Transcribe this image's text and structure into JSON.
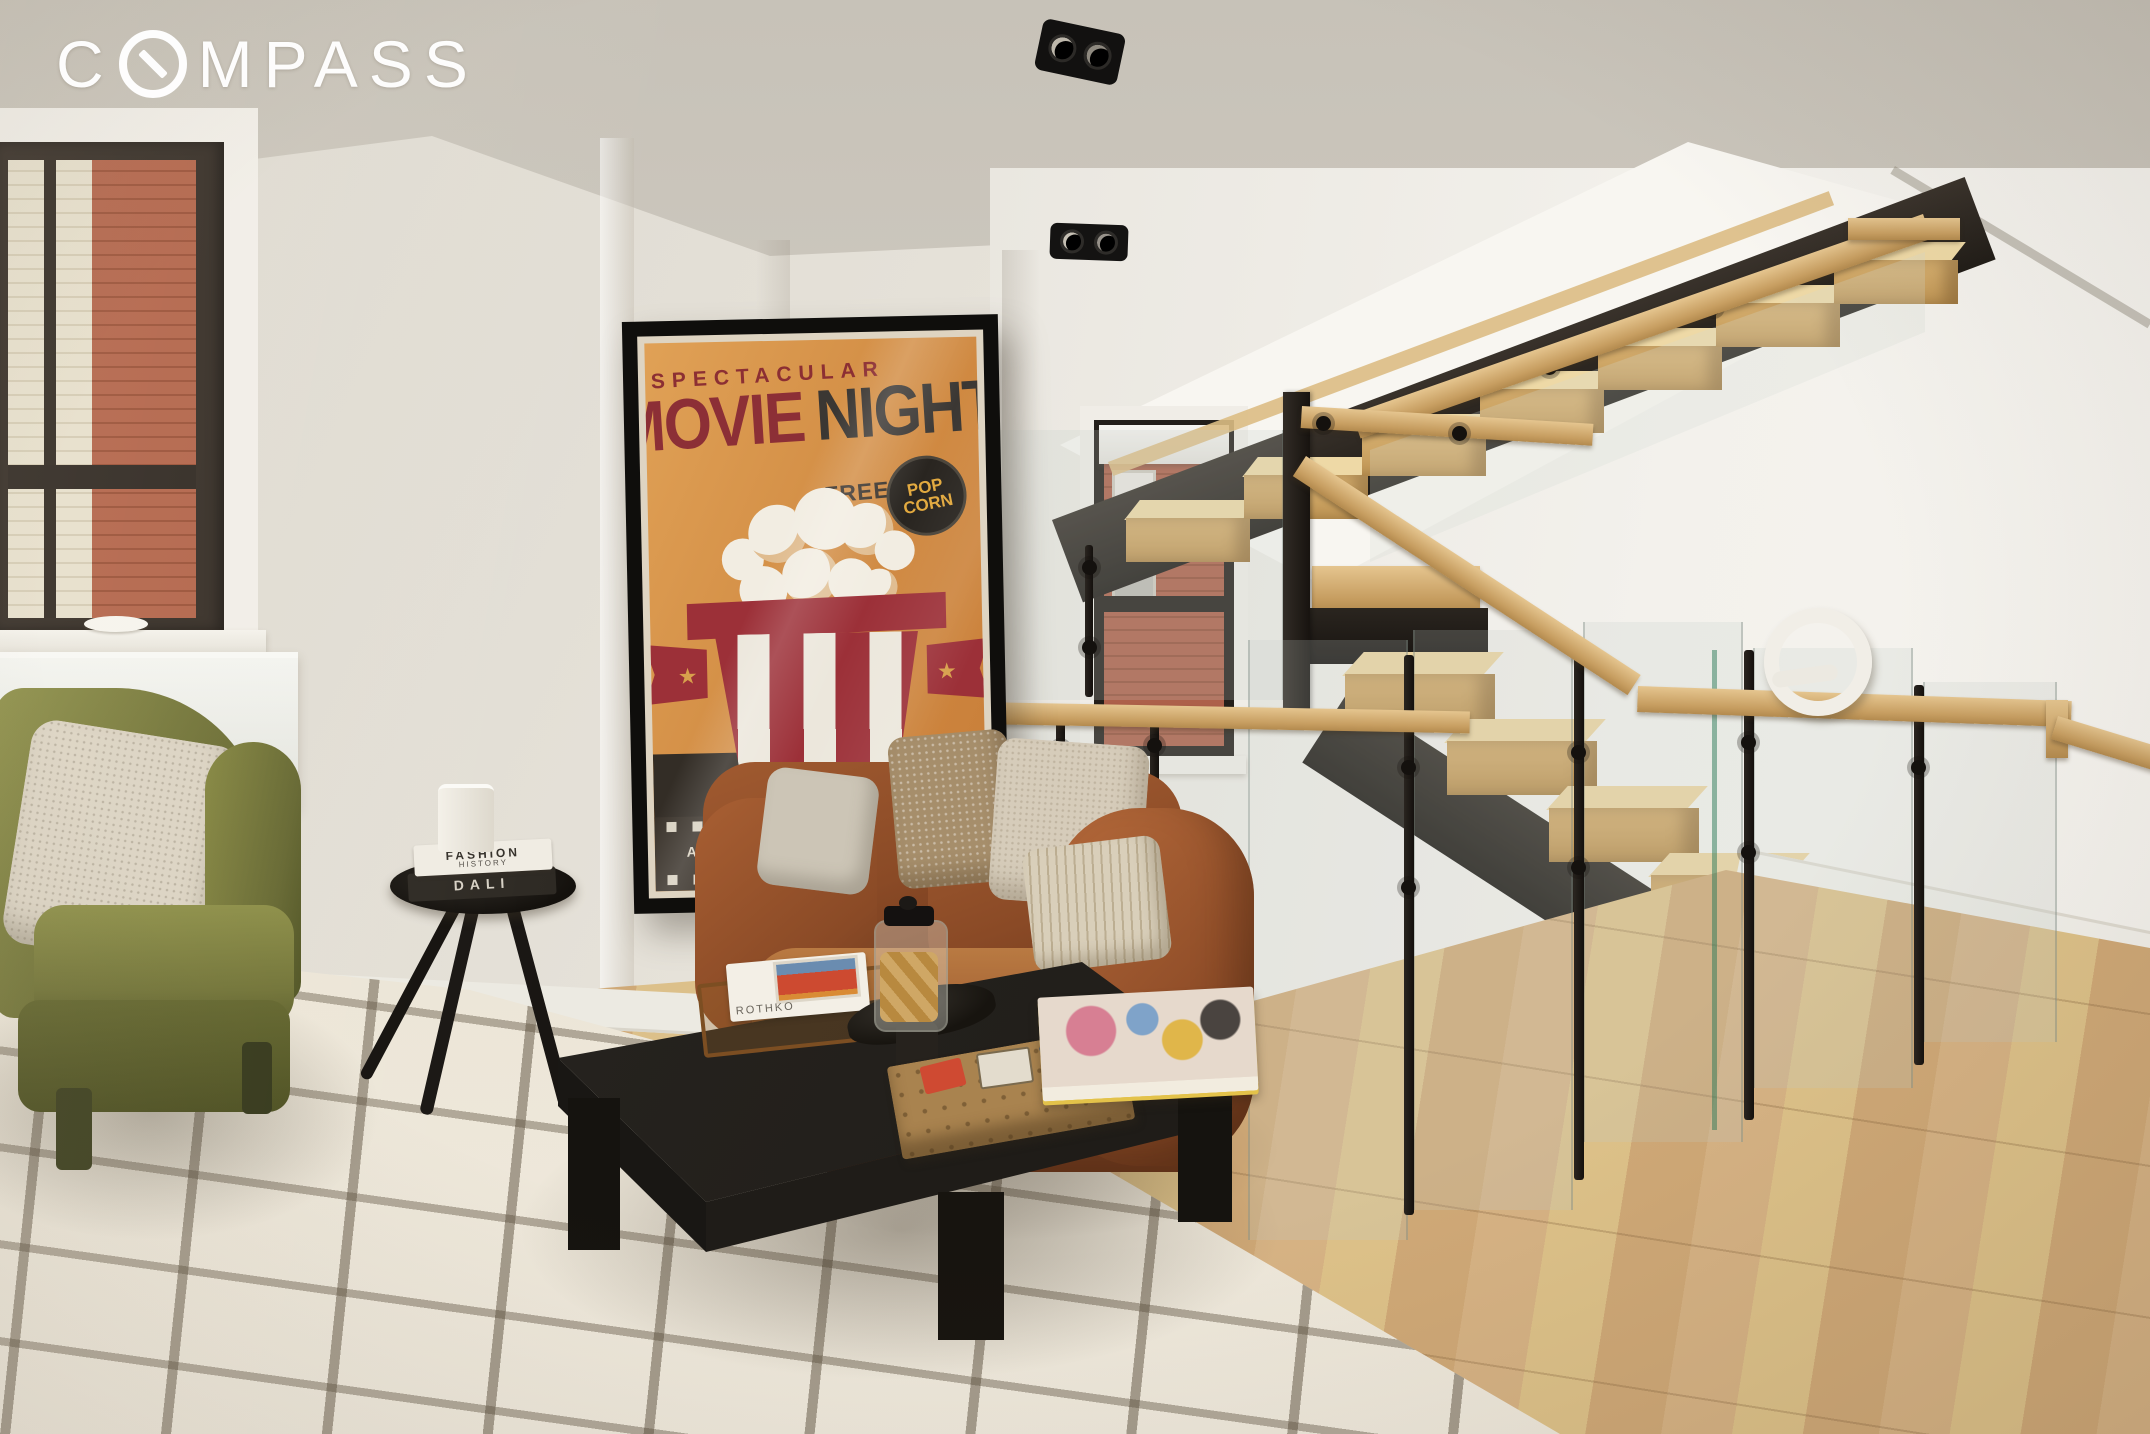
{
  "watermark": {
    "brand": "COMPASS",
    "before_o": "C",
    "after_o": "MPASS"
  },
  "poster": {
    "kicker": "SPECTACULAR",
    "title_word1": "MOVIE",
    "title_word2": "NIGHT!",
    "free_label": "FREE",
    "badge_top": "POP",
    "badge_bottom": "CORN",
    "banner": "AT YOUR LOCAL CINEMA · FRIDAY 17:00"
  },
  "side_table_books": {
    "book1_line1": "FASHION",
    "book1_line2": "HISTORY",
    "book2": "DALI"
  },
  "coffee_table_books": {
    "spine": "ROTHKO"
  },
  "scene": {
    "description": "Loft living room with cognac leather sofa, vintage movie-night poster, olive velvet armchair, sculpted cream rug and floating oak staircase with glass railing",
    "colors": {
      "wall": "#e7e3da",
      "ceiling": "#cdc8bf",
      "poster_orange": "#d28a42",
      "poster_maroon": "#93303a",
      "poster_dark": "#3a332b",
      "badge_gold": "#e2a93e",
      "leather": "#96512a",
      "olive_velvet": "#75763a",
      "oak": "#d9b883",
      "steel": "#2b2622",
      "rug": "#e7e0d1",
      "floor": "#d3ac7c",
      "brick_red": "#b2644a",
      "brick_cream": "#e6dfcc"
    }
  }
}
